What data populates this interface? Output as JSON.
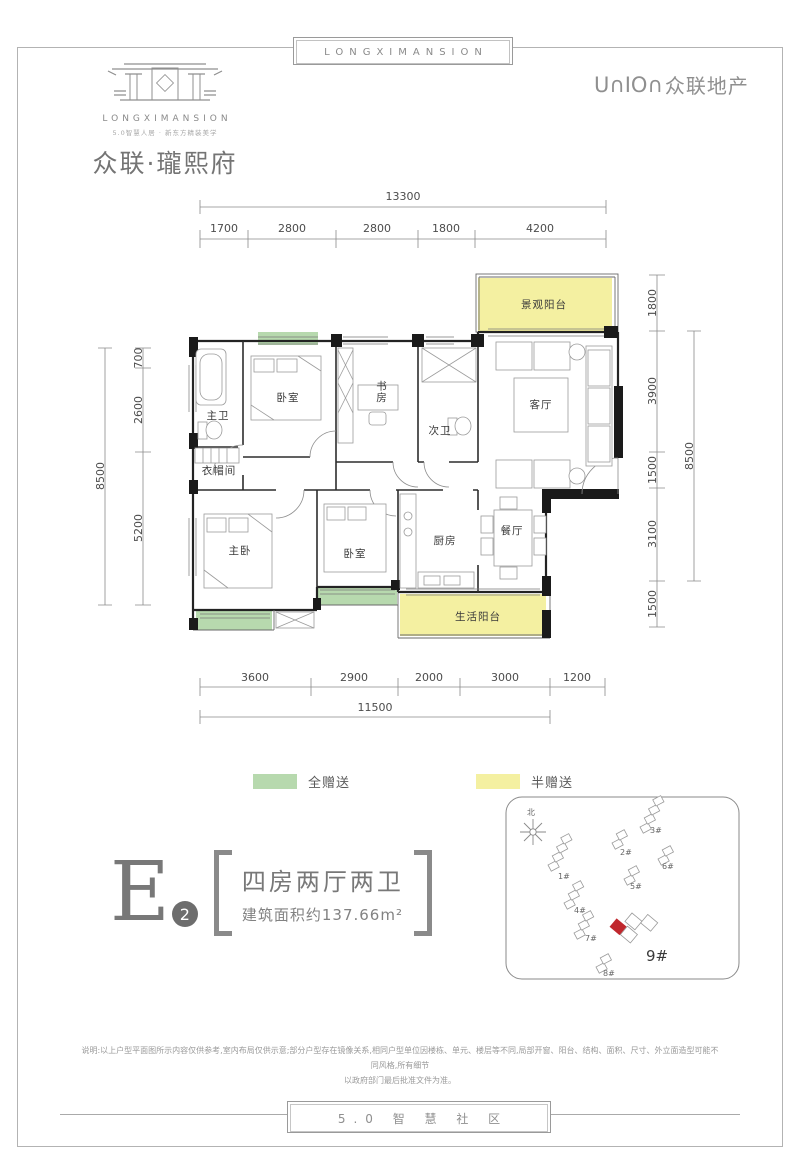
{
  "banner": {
    "top": "LONGXIMANSION",
    "footer": "5.0 智 慧 社 区"
  },
  "header": {
    "brand_en": "LONGXIMANSION",
    "brand_tagline": "5.0智慧人居 · 新东方精装美学",
    "brand_cn": "众联·瓏熙府",
    "developer_mark": "U∩IO∩",
    "developer_name": "众联地产"
  },
  "floor_plan": {
    "rooms": [
      "景观阳台",
      "客厅",
      "卧室",
      "书房",
      "次卫",
      "主卫",
      "衣帽间",
      "主卧",
      "卧室",
      "厨房",
      "餐厅",
      "生活阳台"
    ],
    "dims": {
      "top_total": "13300",
      "top": [
        "1700",
        "2800",
        "2800",
        "1800",
        "4200"
      ],
      "bottom": [
        "3600",
        "2900",
        "2000",
        "3000",
        "1200"
      ],
      "bottom_total": "11500",
      "left": [
        "700",
        "2600",
        "5200"
      ],
      "left_total": "8500",
      "right": [
        "1800",
        "3900",
        "1500",
        "3100",
        "1500"
      ],
      "right_total": "8500"
    }
  },
  "legend": {
    "full": "全赠送",
    "half": "半赠送",
    "full_color": "#b7d9ae",
    "half_color": "#f4f0a1"
  },
  "unit": {
    "letter": "E",
    "number": "2",
    "layout": "四房两厅两卫",
    "area": "建筑面积约137.66m²"
  },
  "site_plan": {
    "north": "北",
    "buildings": [
      "1#",
      "2#",
      "3#",
      "4#",
      "5#",
      "6#",
      "7#",
      "8#"
    ],
    "highlight": "9#"
  },
  "disclaimer": {
    "line1": "说明:以上户型平面图所示内容仅供参考,室内布局仅供示意;部分户型存在镜像关系,相同户型单位因楼栋、单元、楼层等不同,局部开窗、阳台、结构、面积、尺寸、外立面造型可能不同风格,所有细节",
    "line2": "以政府部门最后批准文件为准。"
  },
  "colors": {
    "gift_full": "#b7d9ae",
    "gift_half": "#f4f0a1",
    "highlight_red": "#c0272d",
    "wall": "#1a1a1a",
    "brand_gray": "#8a8a8a"
  }
}
